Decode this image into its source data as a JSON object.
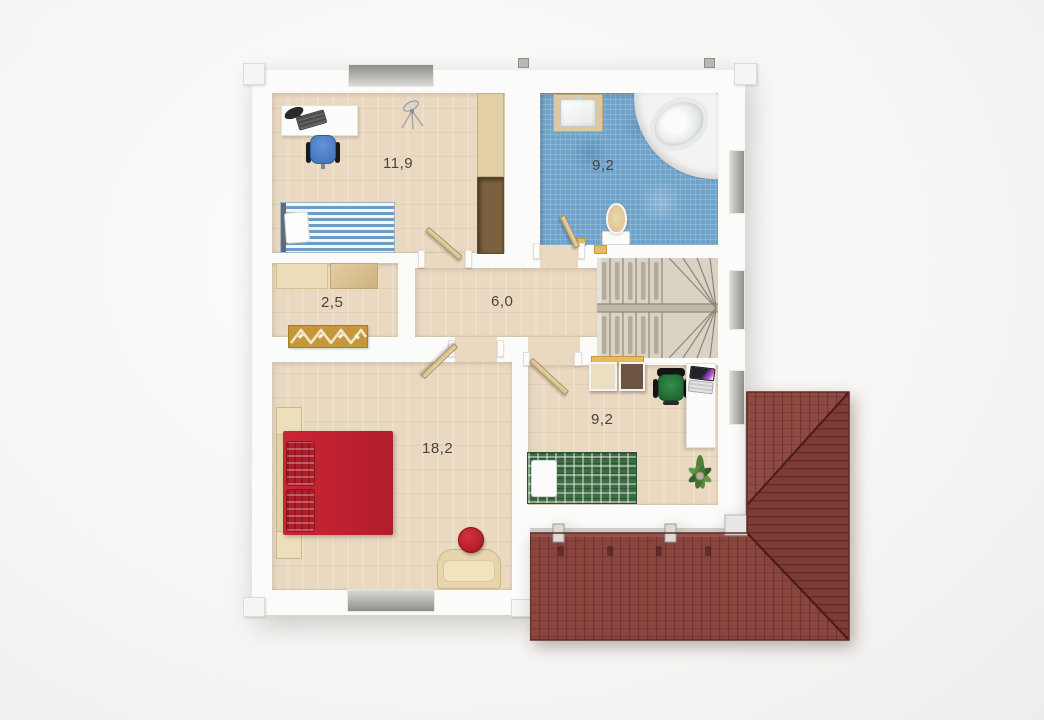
{
  "plan": {
    "view": "top-down-3d-floor-plan",
    "rooms": [
      {
        "id": "room-upper-left",
        "area_label": "11,9",
        "furniture": [
          "desk",
          "desk-lamp",
          "keyboard",
          "office-chair-blue",
          "standing-fan",
          "single-bed-blue-striped",
          "wardrobe"
        ]
      },
      {
        "id": "bathroom",
        "area_label": "9,2",
        "furniture": [
          "washbasin-vanity",
          "corner-bathtub",
          "toilet"
        ]
      },
      {
        "id": "closet",
        "area_label": "2,5",
        "furniture": [
          "shelf-unit-light",
          "shelf-unit-dark",
          "shoe-rack"
        ]
      },
      {
        "id": "hall",
        "area_label": "6,0",
        "furniture": []
      },
      {
        "id": "bedroom",
        "area_label": "18,2",
        "furniture": [
          "double-bed-red",
          "nightstand-top",
          "nightstand-bottom",
          "bench",
          "ottoman-red"
        ]
      },
      {
        "id": "room-lower-right",
        "area_label": "9,2",
        "furniture": [
          "storage-box-light",
          "storage-box-dark",
          "office-chair-green",
          "desk",
          "laptop",
          "single-bed-green-plaid",
          "potted-plant"
        ]
      }
    ],
    "staircase": {
      "id": "winder-staircase"
    },
    "roof": {
      "id": "hipped-tile-roof"
    },
    "colors": {
      "wall_white": "#fbfbf9",
      "wood_floor": "#ead9c0",
      "bathroom_tile_blue": "#6fa3c9",
      "roof_tile_red": "#87423c",
      "bed_red": "#c4212f",
      "bed_green": "#3e6c44",
      "bed_blue": "#6d9cc6",
      "chair_blue": "#4d82cc",
      "chair_green": "#2e7d3b",
      "accent_gold": "#e6bb5e",
      "stair_taupe": "#d9d2c5"
    }
  }
}
